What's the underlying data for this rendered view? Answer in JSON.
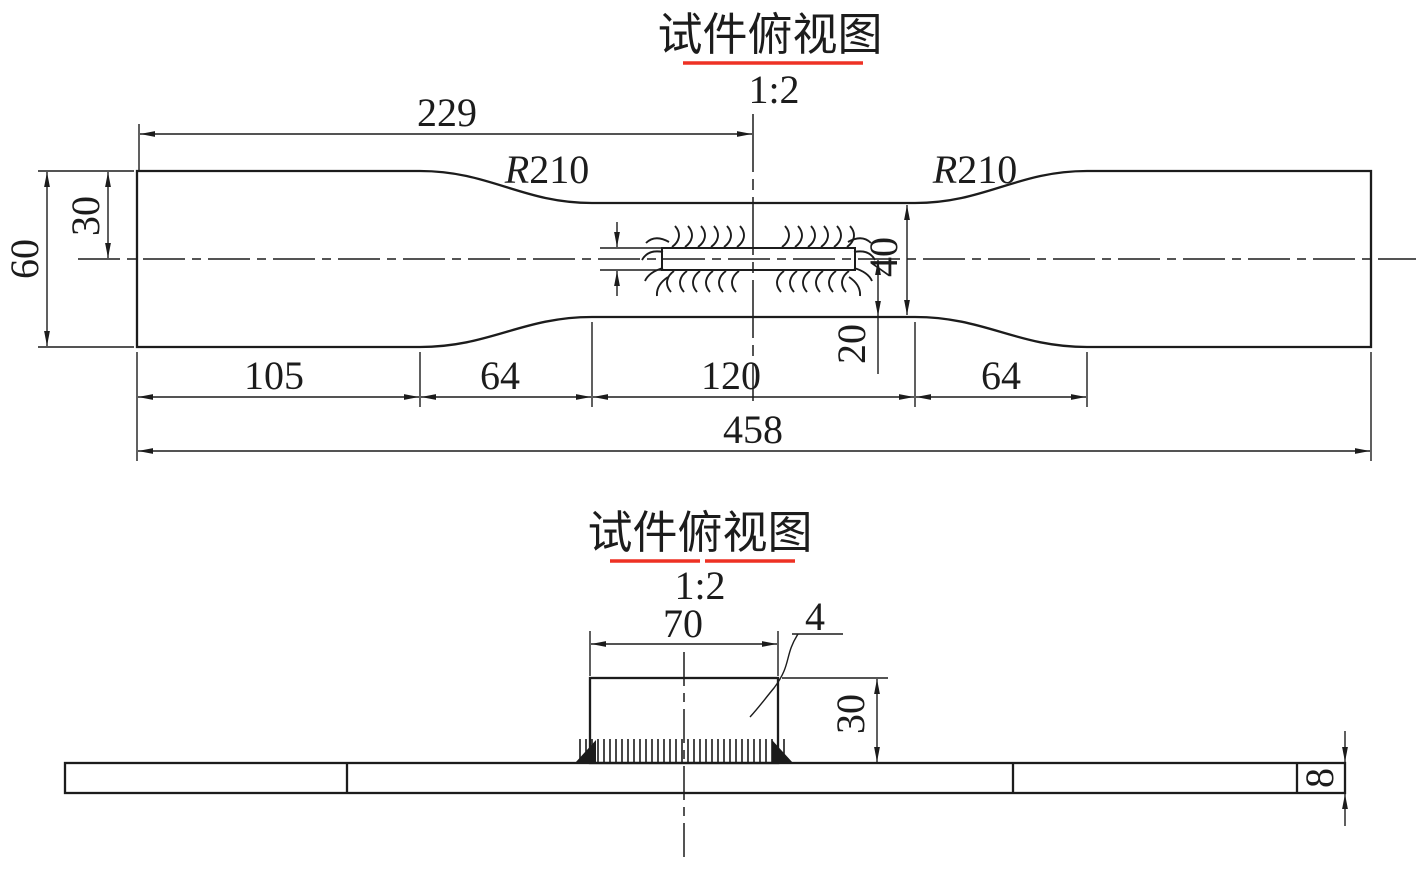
{
  "colors": {
    "line": "#1c1c1c",
    "underline": "#ee3124",
    "background": "#ffffff"
  },
  "top_view": {
    "title": "试件俯视图",
    "scale": "1:2",
    "radius_prefix": "R",
    "radius_value": "210",
    "dims": {
      "left_to_center": "229",
      "half_width": "30",
      "width": "60",
      "weld_plate_width": "40",
      "weld_half_width": "20",
      "grip_left": "105",
      "transition_left": "64",
      "gauge_length": "120",
      "transition_right": "64",
      "total_length": "458"
    }
  },
  "side_view": {
    "title": "试件俯视图",
    "scale": "1:2",
    "dims": {
      "plate_length": "70",
      "weld_leg": "4",
      "plate_height": "30",
      "thickness": "8"
    }
  }
}
